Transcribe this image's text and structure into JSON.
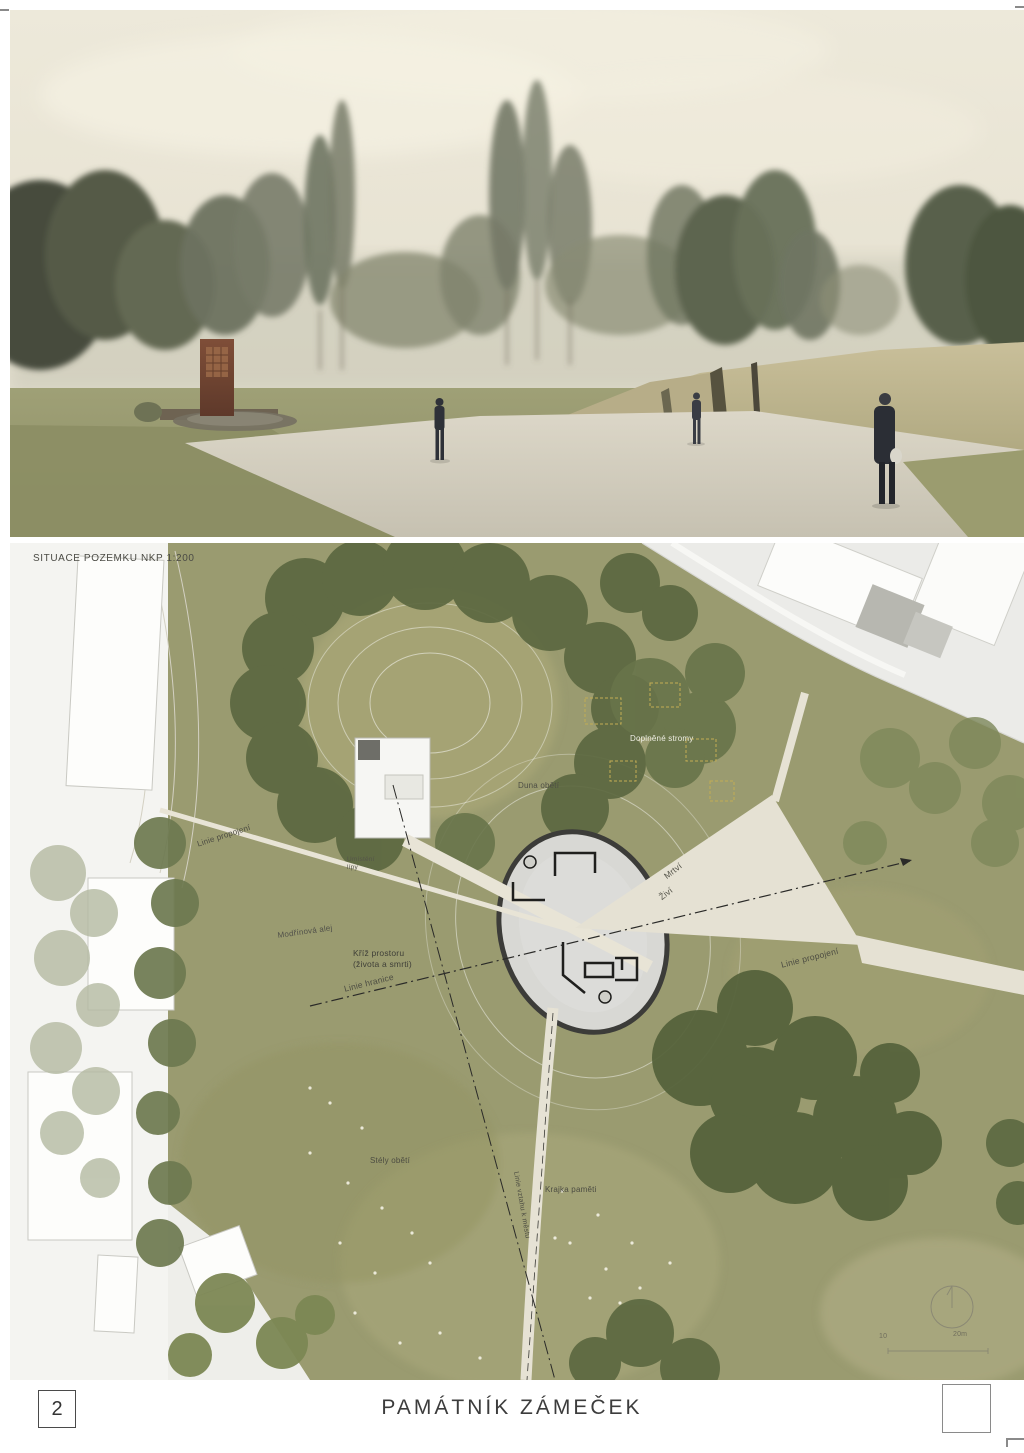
{
  "page": {
    "number": "2",
    "title": "PAMÁTNÍK ZÁMEČEK"
  },
  "plan": {
    "heading": "SITUACE POZEMKU NKP 1:200",
    "labels": {
      "linie_propojeni_left": "Linie propojení",
      "umisteni_lipy": "Umístění\nlípy",
      "modrinova_alej": "Modřínová alej",
      "kriz_prostoru": "Kříž prostoru\n(života a smrti)",
      "linie_hranice": "Linie hranice",
      "duna_obeti": "Duna obětí",
      "doplnene_stromy": "Doplněné stromy",
      "mrtvi": "Mrtví",
      "zivi": "Živí",
      "linie_propojeni_right": "Linie propojení",
      "stely_obeti": "Stély obětí",
      "krajka_pameti": "Krajka paměti",
      "linie_vztahu": "Linie vztahu k městu"
    },
    "scale_bar": {
      "tick_mid": "10",
      "tick_end": "20m"
    }
  },
  "colors": {
    "sky": "#EAE5D5",
    "park_green": "#9A9B70",
    "tree_dark": "#5C6840",
    "path_light": "#E5E1D3",
    "plan_oval_grey": "#D8D8D4",
    "brick": "#7F4E38"
  }
}
